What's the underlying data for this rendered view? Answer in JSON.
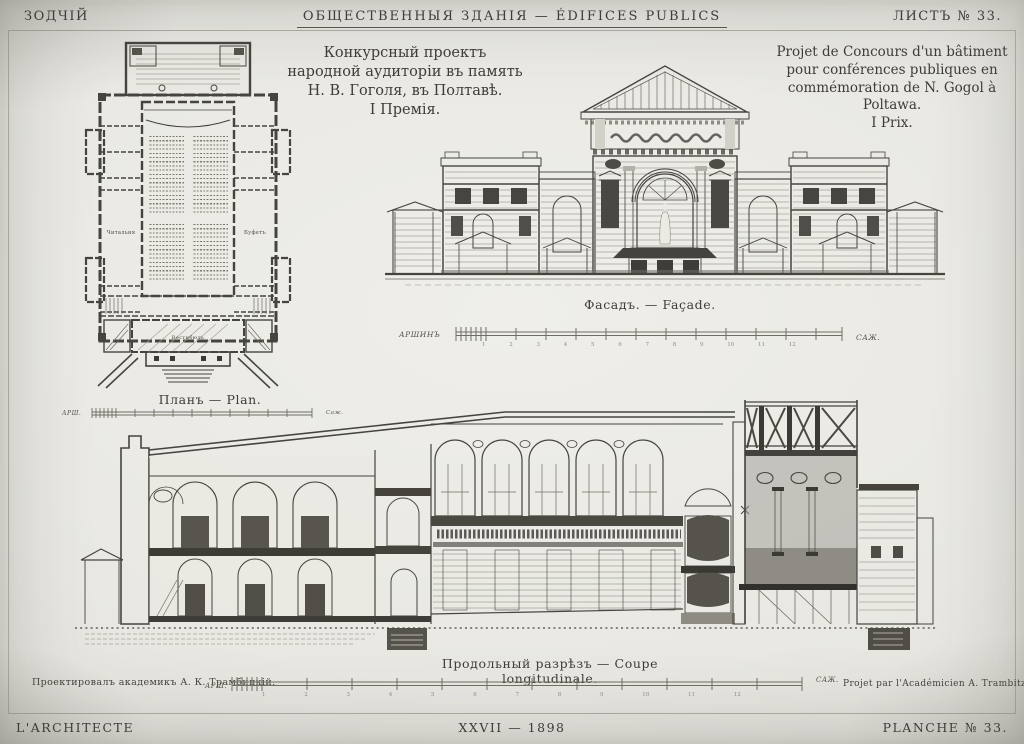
{
  "header": {
    "journal": "ЗОДЧІЙ",
    "rubric": "ОБЩЕСТВЕННЫЯ ЗДАНІЯ — ÉDIFICES PUBLICS",
    "sheet": "ЛИСТЪ № 33."
  },
  "title_ru": [
    "Конкурсный проектъ",
    "народной аудиторіи въ память",
    "Н. В. Гоголя, въ Полтавѣ.",
    "I Премія."
  ],
  "title_fr": [
    "Projet de Concours d'un bâtiment",
    "pour conférences publiques en",
    "commémoration de N. Gogol à Poltawa.",
    "I Prix."
  ],
  "captions": {
    "plan": "Планъ — Plan.",
    "facade": "Фасадъ. — Façade.",
    "section": "Продольный разрѣзъ — Coupe longitudinale."
  },
  "plan_labels": {
    "reading_room": "Читальня",
    "buffet": "Буфетъ",
    "vestibule": "Вестибюль"
  },
  "scales": {
    "facade_left": "АРШИНЪ",
    "facade_right": "САЖ.",
    "plan_left": "АРШ.",
    "plan_right": "Саж.",
    "section_left": "АРШ.",
    "section_right": "САЖ.",
    "numbers": "1 2 3 4 5 6 7 8 9 10 11 12"
  },
  "credits": {
    "ru": "Проектировалъ академикъ А. К. Трамбицкій.",
    "fr": "Projet par l'Académicien A. Trambitzky."
  },
  "footer": {
    "left": "L'ARCHITECTE",
    "center": "XXVII — 1898",
    "right": "PLANCHE № 33."
  },
  "colors": {
    "paper": "#e9e8e3",
    "ink": "#3e3c38"
  }
}
